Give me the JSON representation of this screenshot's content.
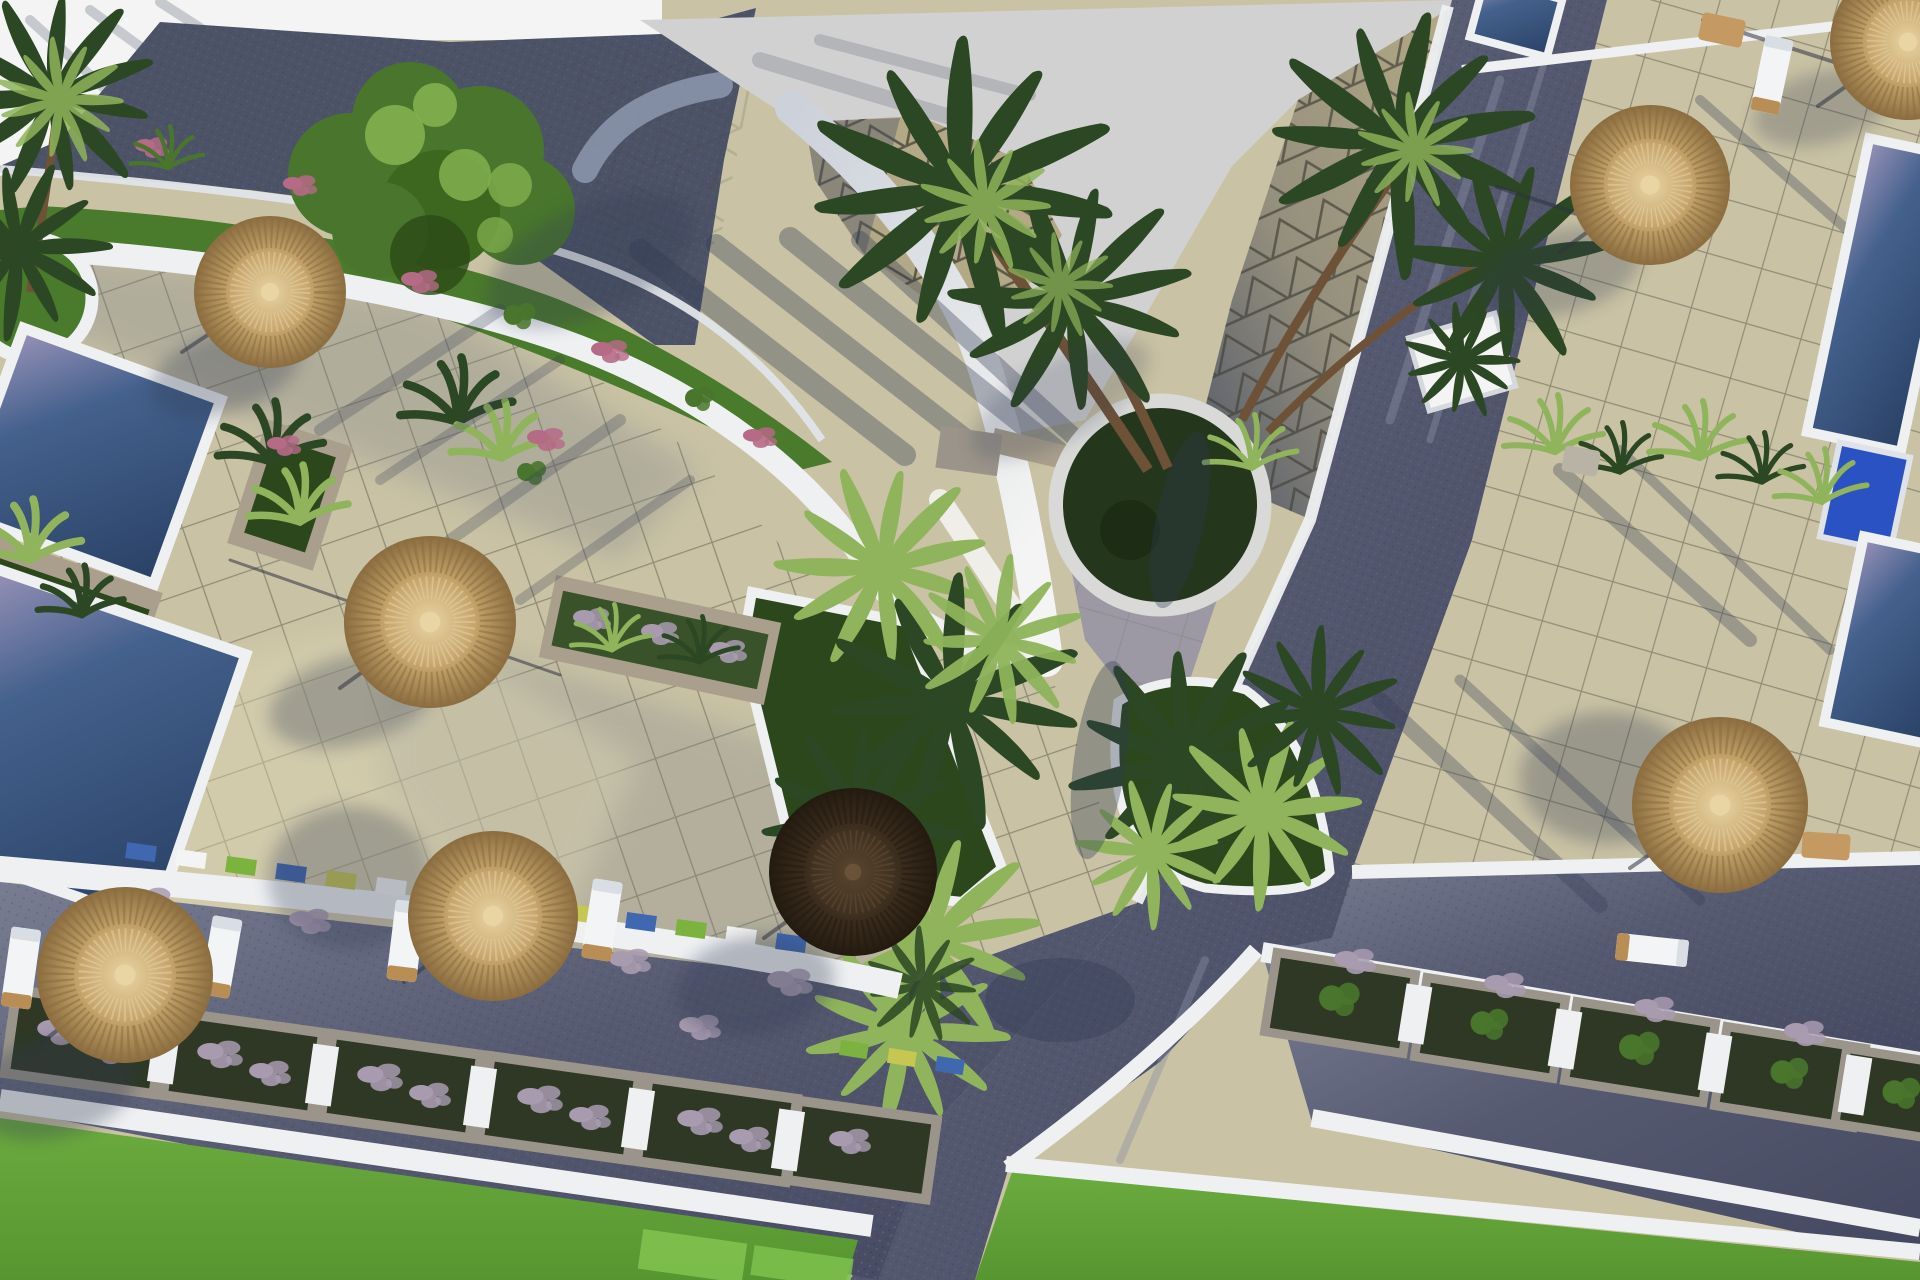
{
  "scene": {
    "type": "aerial-3d-architectural-render",
    "description": "Top-down 3D rendering of a resort courtyard: beige tiled terraces, dark paved walkways, swimming pools, thatched parasols with sun loungers, palm trees, lavender planters, lawns and curved white walls",
    "objects": [
      "tiled-terrace",
      "paved-walkway",
      "swimming-pool",
      "thatch-parasol",
      "dark-parasol",
      "sun-lounger",
      "palm-tree",
      "leafy-tree",
      "lawn",
      "lavender-planter",
      "curved-white-wall",
      "triangle-pattern-roof",
      "round-tree-planter"
    ],
    "counts": {
      "thatch_parasols": 7,
      "dark_parasols": 1,
      "left_pools": 2,
      "right_pools": 3,
      "sun_loungers": 6,
      "round_planters": 1
    }
  },
  "palette": {
    "base": "#c9c2a4",
    "tileLine": "#5a564b",
    "tileShadow": "#7b8089",
    "tileBright": "#ded7b5",
    "road": "#565a71",
    "roadDark": "#434860",
    "roadLight": "#787d92",
    "white": "#f3f4f3",
    "whiteSoft": "#ccd1da",
    "grayFlat": "#d1d1d1",
    "roofTan": "#b4a986",
    "roofLine": "#46443b",
    "roofShadow": "#4c5367",
    "poolDeep": "#2c4368",
    "poolMid": "#44618d",
    "poolSheen": "#9a93b8",
    "grassBright": "#6cab3f",
    "grassDeep": "#2d471d",
    "lawn": "#4a7a2b",
    "treeGreen": "#49762c",
    "treeLight": "#83b04f",
    "palmDark": "#2c4723",
    "palmLight": "#8fb45b",
    "thatchHi": "#e9d4a4",
    "thatchMid": "#c3a269",
    "thatchLo": "#8b6d40",
    "thatchDark": "#3c2e1e",
    "thatchDeep": "#241b10",
    "trunk": "#6e5238",
    "stone": "#a99f8c",
    "lavender": "#a89bb0",
    "bloomPink": "#b56a86",
    "shadow": "#303a52",
    "curb": "#eef0f2",
    "accentBlue": "#4068b0",
    "accentGreen": "#7cb23e",
    "accentYellow": "#c6c653",
    "boxBlue": "#2b52c2"
  }
}
